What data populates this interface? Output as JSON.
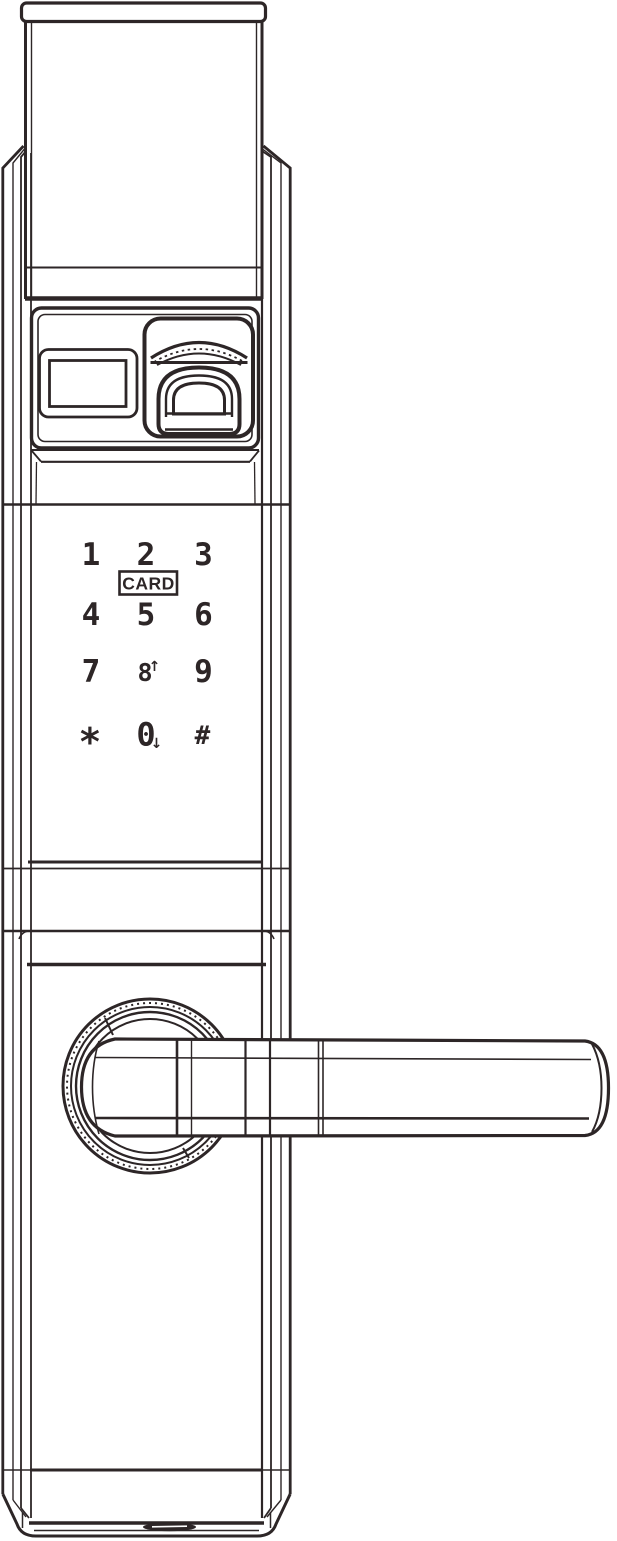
{
  "colors": {
    "line": "#2d2627",
    "background": "#ffffff"
  },
  "keypad": {
    "card_label": "CARD",
    "keys": [
      {
        "label": "1"
      },
      {
        "label": "2"
      },
      {
        "label": "3"
      },
      {
        "label": "4"
      },
      {
        "label": "5"
      },
      {
        "label": "6"
      },
      {
        "label": "7"
      },
      {
        "label": "8",
        "arrow": "↑"
      },
      {
        "label": "9"
      },
      {
        "label": "*"
      },
      {
        "label": "0",
        "arrow": "↓"
      },
      {
        "label": "#"
      }
    ]
  }
}
